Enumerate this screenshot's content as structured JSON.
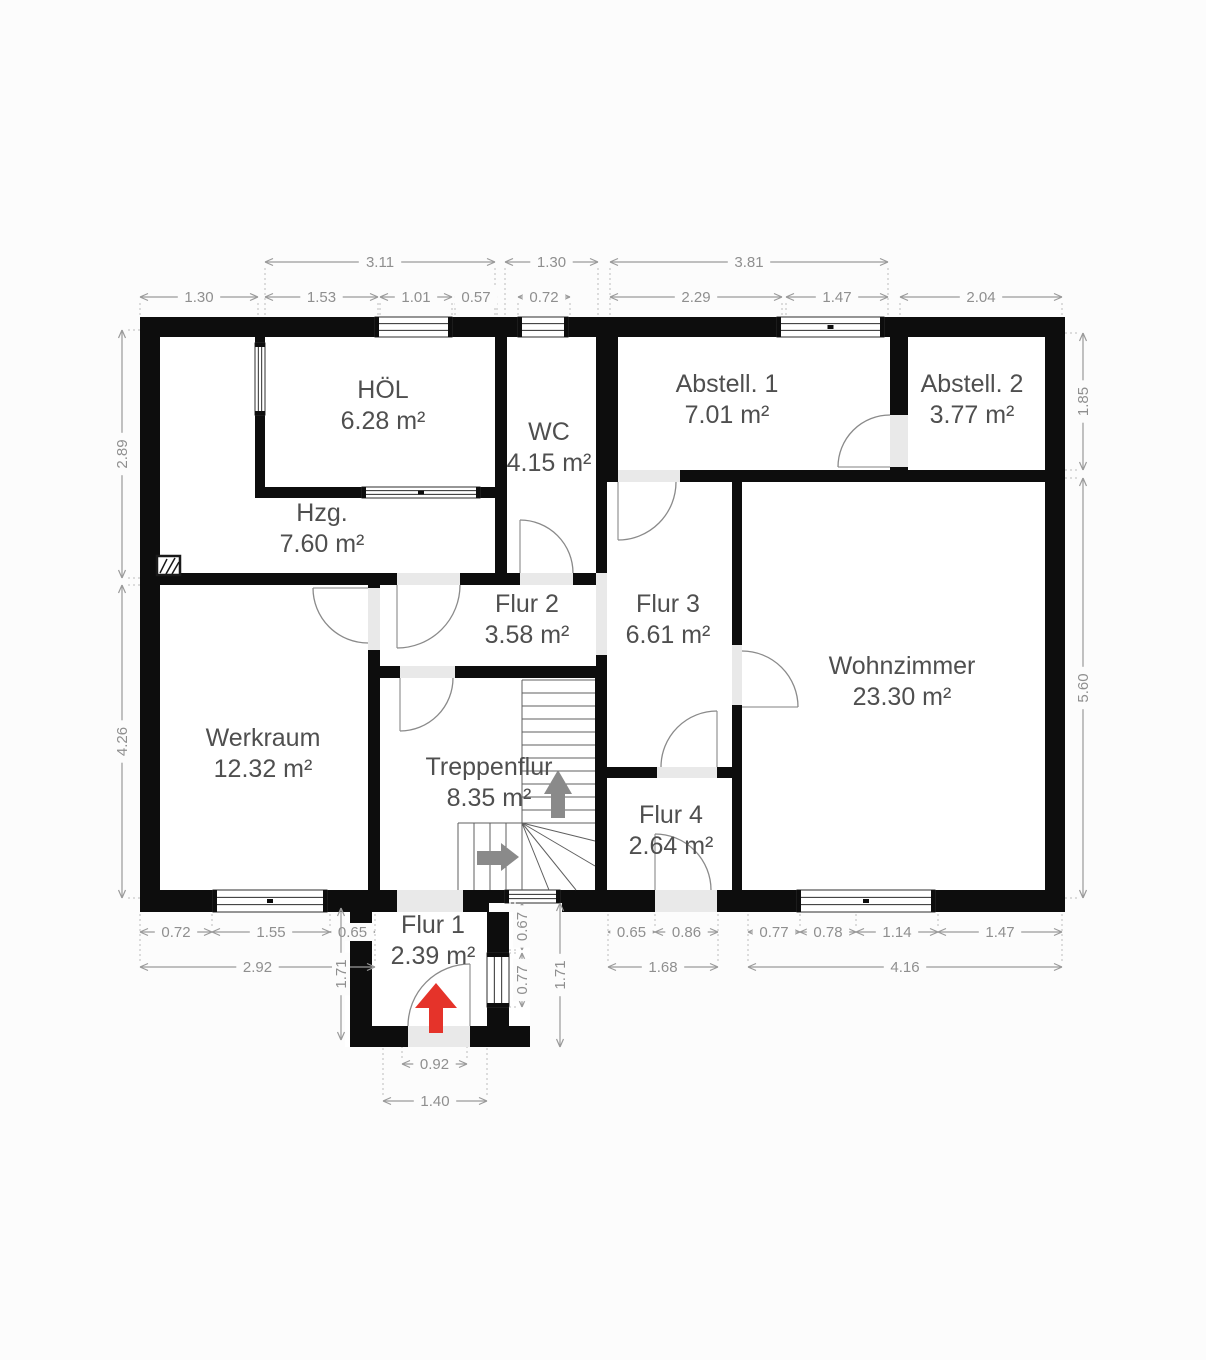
{
  "plan_title": "Erdgeschoss Grundriss",
  "colors": {
    "wall": "#0d0d0d",
    "floor": "#ffffff",
    "threshold": "#e9e9e9",
    "dim_line": "#9a9a9a",
    "dim_text": "#8f8f8f",
    "room_label": "#4f4f4f",
    "stair_line": "#5f5f5f",
    "door_line": "#8a8a8a",
    "entrance_arrow": "#e5332a",
    "stair_arrow": "#8a8a8a",
    "background": "#fcfcfc"
  },
  "icons": {
    "entrance_arrow": "red-up-arrow",
    "stairs_up_arrow": "gray-up-arrow",
    "stairs_direction_arrow": "gray-right-arrow",
    "chimney": "hatched-square"
  },
  "rooms": [
    {
      "name": "HÖL",
      "area": "6.28 m²",
      "x": 383,
      "y": 398
    },
    {
      "name": "WC",
      "area": "4.15 m²",
      "x": 549,
      "y": 440
    },
    {
      "name": "Abstell. 1",
      "area": "7.01 m²",
      "x": 727,
      "y": 392
    },
    {
      "name": "Abstell. 2",
      "area": "3.77 m²",
      "x": 972,
      "y": 392
    },
    {
      "name": "Hzg.",
      "area": "7.60 m²",
      "x": 322,
      "y": 521
    },
    {
      "name": "Flur 2",
      "area": "3.58 m²",
      "x": 527,
      "y": 612
    },
    {
      "name": "Flur 3",
      "area": "6.61 m²",
      "x": 668,
      "y": 612
    },
    {
      "name": "Wohnzimmer",
      "area": "23.30 m²",
      "x": 902,
      "y": 674
    },
    {
      "name": "Werkraum",
      "area": "12.32 m²",
      "x": 263,
      "y": 746
    },
    {
      "name": "Treppenflur",
      "area": "8.35 m²",
      "x": 489,
      "y": 775
    },
    {
      "name": "Flur 4",
      "area": "2.64 m²",
      "x": 671,
      "y": 823
    },
    {
      "name": "Flur 1",
      "area": "2.39 m²",
      "x": 433,
      "y": 933
    }
  ],
  "dimensions": [
    {
      "value": "3.11",
      "o": "h",
      "a": 265,
      "b": 495,
      "c": 262,
      "ext": 317
    },
    {
      "value": "1.30",
      "o": "h",
      "a": 505,
      "b": 598,
      "c": 262,
      "ext": 317
    },
    {
      "value": "3.81",
      "o": "h",
      "a": 610,
      "b": 888,
      "c": 262,
      "ext": 317
    },
    {
      "value": "1.30",
      "o": "h",
      "a": 140,
      "b": 258,
      "c": 297,
      "ext": 317
    },
    {
      "value": "1.53",
      "o": "h",
      "a": 265,
      "b": 378,
      "c": 297,
      "ext": 317
    },
    {
      "value": "1.01",
      "o": "h",
      "a": 380,
      "b": 452,
      "c": 297,
      "ext": 317
    },
    {
      "value": "0.57",
      "o": "h",
      "a": 455,
      "b": 497,
      "c": 297,
      "ext": 317
    },
    {
      "value": "0.72",
      "o": "h",
      "a": 518,
      "b": 570,
      "c": 297,
      "ext": 317
    },
    {
      "value": "2.29",
      "o": "h",
      "a": 610,
      "b": 782,
      "c": 297,
      "ext": 317
    },
    {
      "value": "1.47",
      "o": "h",
      "a": 786,
      "b": 888,
      "c": 297,
      "ext": 317
    },
    {
      "value": "2.04",
      "o": "h",
      "a": 900,
      "b": 1062,
      "c": 297,
      "ext": 317
    },
    {
      "value": "2.89",
      "o": "v",
      "a": 330,
      "b": 578,
      "c": 122,
      "ext": 140
    },
    {
      "value": "4.26",
      "o": "v",
      "a": 585,
      "b": 898,
      "c": 122,
      "ext": 140
    },
    {
      "value": "1.85",
      "o": "v",
      "a": 333,
      "b": 470,
      "c": 1083,
      "ext": 1065
    },
    {
      "value": "5.60",
      "o": "v",
      "a": 478,
      "b": 898,
      "c": 1083,
      "ext": 1065
    },
    {
      "value": "0.72",
      "o": "h",
      "a": 140,
      "b": 212,
      "c": 932,
      "ext": 912
    },
    {
      "value": "1.55",
      "o": "h",
      "a": 212,
      "b": 330,
      "c": 932,
      "ext": 912
    },
    {
      "value": "0.65",
      "o": "h",
      "a": 330,
      "b": 375,
      "c": 932,
      "ext": 912
    },
    {
      "value": "0.65",
      "o": "h",
      "a": 608,
      "b": 655,
      "c": 932,
      "ext": 912
    },
    {
      "value": "0.86",
      "o": "h",
      "a": 655,
      "b": 718,
      "c": 932,
      "ext": 912
    },
    {
      "value": "0.77",
      "o": "h",
      "a": 748,
      "b": 800,
      "c": 932,
      "ext": 912
    },
    {
      "value": "0.78",
      "o": "h",
      "a": 800,
      "b": 856,
      "c": 932,
      "ext": 912
    },
    {
      "value": "1.14",
      "o": "h",
      "a": 856,
      "b": 938,
      "c": 932,
      "ext": 912
    },
    {
      "value": "1.47",
      "o": "h",
      "a": 938,
      "b": 1062,
      "c": 932,
      "ext": 912
    },
    {
      "value": "2.92",
      "o": "h",
      "a": 140,
      "b": 375,
      "c": 967,
      "ext": 912
    },
    {
      "value": "1.68",
      "o": "h",
      "a": 608,
      "b": 718,
      "c": 967,
      "ext": 912
    },
    {
      "value": "4.16",
      "o": "h",
      "a": 748,
      "b": 1062,
      "c": 967,
      "ext": 912
    },
    {
      "value": "1.71",
      "o": "v",
      "a": 908,
      "b": 1040,
      "c": 341
    },
    {
      "value": "0.67",
      "o": "v",
      "a": 903,
      "b": 950,
      "c": 522,
      "ext": 509
    },
    {
      "value": "0.77",
      "o": "v",
      "a": 953,
      "b": 1007,
      "c": 522,
      "ext": 509
    },
    {
      "value": "1.71",
      "o": "v",
      "a": 903,
      "b": 1047,
      "c": 560
    },
    {
      "value": "0.92",
      "o": "h",
      "a": 402,
      "b": 467,
      "c": 1064,
      "ext": 1047
    },
    {
      "value": "1.40",
      "o": "h",
      "a": 383,
      "b": 487,
      "c": 1101,
      "ext": 1047
    }
  ]
}
